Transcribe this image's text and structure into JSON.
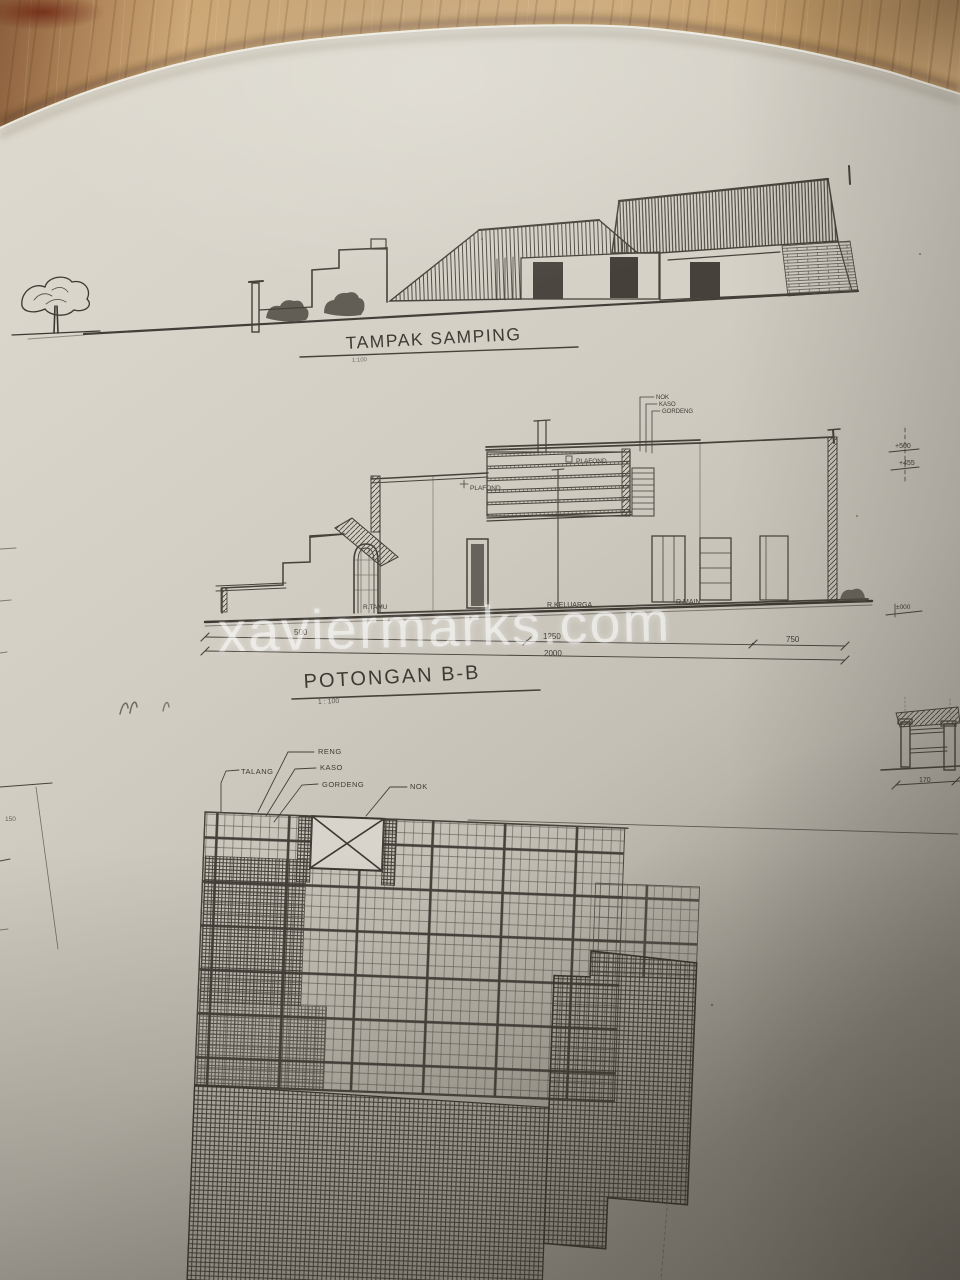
{
  "photo": {
    "watermark": "xaviermarks.com"
  },
  "elevation": {
    "title": "TAMPAK SAMPING",
    "scale": "1:100"
  },
  "section": {
    "title": "POTONGAN B-B",
    "scale": "1 : 100",
    "roof_labels": {
      "nok": "NOK",
      "kaso": "KASO",
      "gordeng": "GORDENG"
    },
    "plafond_left": "PLAFOND",
    "plafond_right": "PLAFOND",
    "rooms": {
      "left": "R.TAMU",
      "middle": "R.KELUARGA",
      "right": "R.MAIN"
    },
    "dimensions": {
      "seg1": "500",
      "seg2": "1250",
      "seg3": "750",
      "total": "2000"
    },
    "levels": {
      "upper": "+500",
      "lower": "+455",
      "datum": "±000"
    }
  },
  "roof_plan": {
    "labels": {
      "talang": "TALANG",
      "reng": "RENG",
      "kaso": "KASO",
      "gordeng": "GORDENG",
      "nok": "NOK"
    }
  },
  "right_detail": {
    "dimension": "170"
  },
  "left_edge": {
    "dimension": "150"
  }
}
